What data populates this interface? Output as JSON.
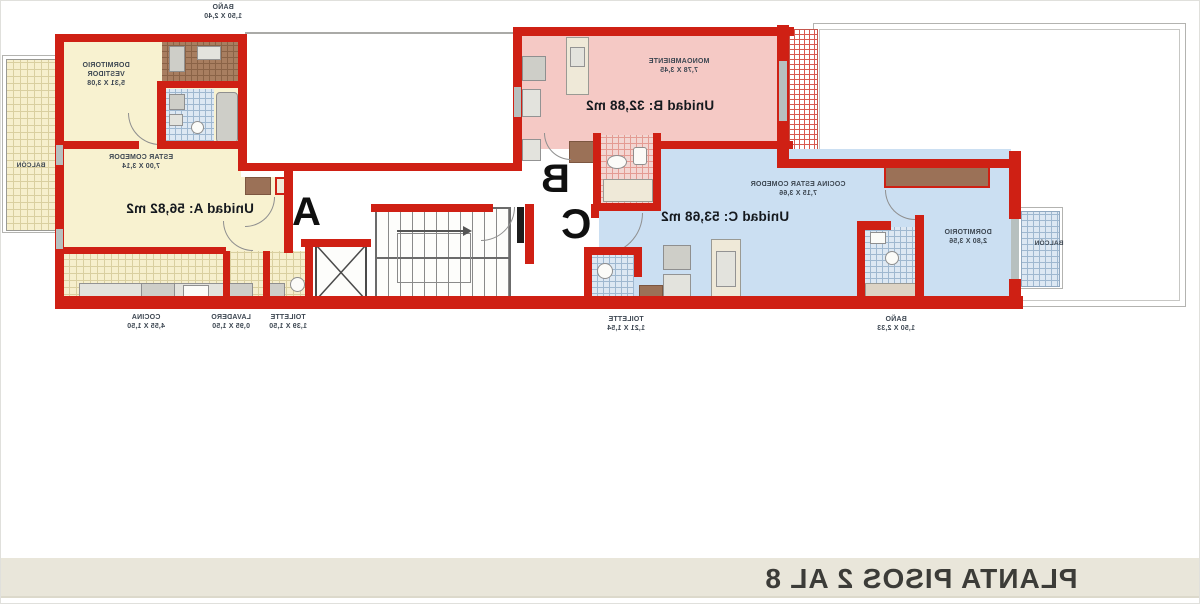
{
  "footer": {
    "title": "PLANTA PISOS 2 AL 8"
  },
  "colors": {
    "wall": "#cf2014",
    "unit_a_floor": "#f8f2d0",
    "unit_b_floor": "#f5c9c5",
    "unit_c_floor": "#cbdff2",
    "closet_brown": "#9b7157",
    "footer_band": "#e9e6da"
  },
  "units": [
    {
      "id": "A",
      "letter": "A",
      "area_label": "Unidad A: 56,82 m2"
    },
    {
      "id": "B",
      "letter": "B",
      "area_label": "Unidad B: 32,88 m2"
    },
    {
      "id": "C",
      "letter": "C",
      "area_label": "Unidad C: 53,68 m2"
    }
  ],
  "labels": [
    {
      "id": "bano-a-top",
      "lines": [
        "BAÑO",
        "1,50 X 2,40"
      ]
    },
    {
      "id": "dormitorio-a",
      "lines": [
        "DORMITORIO",
        "VESTIDOR",
        "5,31 X 3,08"
      ]
    },
    {
      "id": "estar-comedor-a",
      "lines": [
        "ESTAR COMEDOR",
        "7,00 X 3,14"
      ]
    },
    {
      "id": "balcon-a",
      "lines": [
        "BALCÓN"
      ]
    },
    {
      "id": "cocina-a",
      "lines": [
        "COCINA",
        "4,55 X 1,50"
      ]
    },
    {
      "id": "lavadero-a",
      "lines": [
        "LAVADERO",
        "0,95 X 1,50"
      ]
    },
    {
      "id": "toilette-a",
      "lines": [
        "TOILETTE",
        "1,39 X 1,50"
      ]
    },
    {
      "id": "monoambiente-b",
      "lines": [
        "MONOAMBIENTE",
        "7,78 X 3,45"
      ]
    },
    {
      "id": "cocina-estar-c",
      "lines": [
        "COCINA ESTAR COMEDOR",
        "7,15 X 3,66"
      ]
    },
    {
      "id": "dormitorio-c",
      "lines": [
        "DORMITORIO",
        "2,80 X 3,56"
      ]
    },
    {
      "id": "toilette-c",
      "lines": [
        "TOILETTE",
        "1,21 X 1,54"
      ]
    },
    {
      "id": "bano-c",
      "lines": [
        "BAÑO",
        "1,50 X 2,33"
      ]
    },
    {
      "id": "balcon-c",
      "lines": [
        "BALCÓN"
      ]
    }
  ]
}
